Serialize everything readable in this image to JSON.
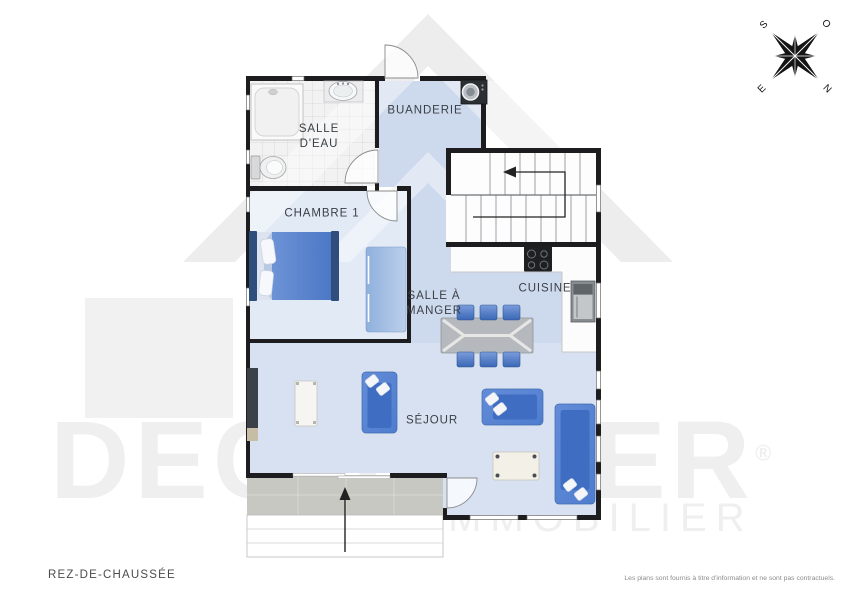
{
  "page": {
    "floor_label": "REZ-DE-CHAUSSÉE",
    "disclaimer": "Les plans sont fournis à titre d'information et ne sont pas contractuels."
  },
  "watermark": {
    "brand": "DECORDIER",
    "registered": "®",
    "tagline": "IMMOBILIER"
  },
  "compass": {
    "north": "N",
    "south": "S",
    "east": "E",
    "west": "O"
  },
  "rooms": {
    "salle_deau": "SALLE\nD'EAU",
    "buanderie": "BUANDERIE",
    "chambre_1": "CHAMBRE 1",
    "salle_a_manger": "SALLE À\nMANGER",
    "cuisine": "CUISINE",
    "sejour": "SÉJOUR"
  },
  "colors": {
    "wall": "#1d1d1f",
    "floor_blue": "#cdd9ec",
    "floor_blue_light": "#d7e1f1",
    "floor_chambre": "#e2eaf6",
    "furniture_blue": "#5b87d5",
    "furniture_blue_dark": "#3f6dc1",
    "terrace_gray": "#c7c8c2",
    "watermark_gray": "#f0eff0"
  }
}
